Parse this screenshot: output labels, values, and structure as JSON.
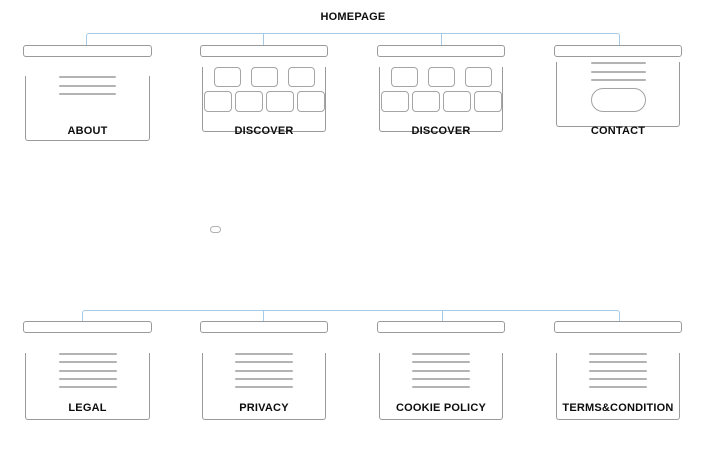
{
  "canvas": {
    "width": 714,
    "height": 470
  },
  "colors": {
    "connector": "#a6cbe8",
    "box_border": "#9a9a9a",
    "wire_line": "#b3b3b3",
    "label_text": "#0d0d0d",
    "background": "#ffffff"
  },
  "homepage": {
    "label": "HOMEPAGE"
  },
  "top_row": [
    {
      "label": "ABOUT",
      "wireframe": "text-block-3-lines"
    },
    {
      "label": "DISCOVER",
      "wireframe": "card-grid-3-over-4"
    },
    {
      "label": "DISCOVER",
      "wireframe": "card-grid-3-over-4"
    },
    {
      "label": "CONTACT",
      "wireframe": "text-3-lines-with-pill-button"
    }
  ],
  "collapsed_node": {
    "shape": "small-ellipse"
  },
  "bottom_row": [
    {
      "label": "LEGAL",
      "wireframe": "text-block-5-lines"
    },
    {
      "label": "PRIVACY",
      "wireframe": "text-block-5-lines"
    },
    {
      "label": "COOKIE POLICY",
      "wireframe": "text-block-5-lines"
    },
    {
      "label": "TERMS&CONDITION",
      "wireframe": "text-block-5-lines"
    }
  ]
}
